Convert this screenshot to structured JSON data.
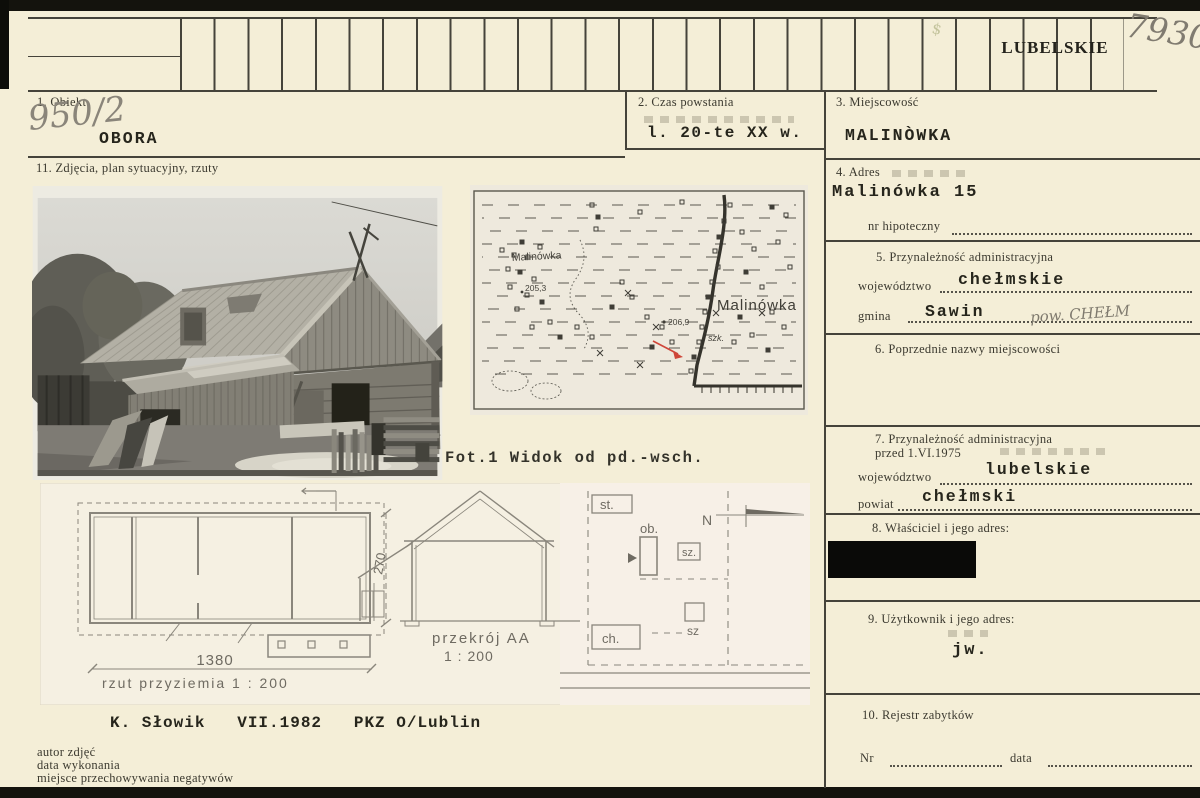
{
  "scan": {
    "region_stamp": "LUBELSKIE",
    "archive_number": "7930",
    "stamp_mark": "$"
  },
  "fields": {
    "obiekt": {
      "label": "1. Obiekt",
      "handwritten_no": "950/2",
      "value": "OBORA"
    },
    "czas": {
      "label": "2. Czas powstania",
      "value": "l. 20-te XX w."
    },
    "miejscowosc": {
      "label": "3. Miejscowość",
      "value": "MALINÒWKA"
    },
    "adres": {
      "label": "4. Adres",
      "value": "Malinówka 15",
      "hipoteczny_label": "nr hipoteczny"
    },
    "przynaleznosc": {
      "label": "5. Przynależność administracyjna",
      "wojewodztwo_label": "województwo",
      "wojewodztwo": "chełmskie",
      "gmina_label": "gmina",
      "gmina": "Sawin",
      "handwritten": "pow. CHEŁM"
    },
    "poprzednie": {
      "label": "6. Poprzednie nazwy miejscowości"
    },
    "przyn_przed": {
      "label": "7. Przynależność administracyjna",
      "label2": "przed 1.VI.1975",
      "wojewodztwo_label": "województwo",
      "wojewodztwo": "lubelskie",
      "powiat_label": "powiat",
      "powiat": "chełmski"
    },
    "wlasciciel": {
      "label": "8. Właściciel i jego adres:"
    },
    "uzytkownik": {
      "label": "9. Użytkownik i jego adres:",
      "value": "jw."
    },
    "rejestr": {
      "label": "10. Rejestr zabytków",
      "nr_label": "Nr",
      "data_label": "data"
    },
    "zdjecia": {
      "label": "11. Zdjęcia, plan sytuacyjny, rzuty"
    }
  },
  "photo": {
    "caption": "Fot.1 Widok od pd.-wsch."
  },
  "map": {
    "label_small": "Malinówka",
    "label_large": "Malinówka",
    "elev1": "205,3",
    "elev2": "206,9",
    "school": "szk."
  },
  "drawings": {
    "dim_len": "1380",
    "dim_h": "270",
    "plan_caption": "rzut przyziemia  1 : 200",
    "section_caption": "przekrój AA",
    "section_scale": "1 : 200",
    "site": {
      "st": "st.",
      "ob": "ob.",
      "sz_a": "sz.",
      "sz_b": "sz",
      "ch": "ch.",
      "north": "N"
    }
  },
  "footer": {
    "credit": "K. Słowik   VII.1982   PKZ O/Lublin",
    "notes": [
      "autor zdjęć",
      "data wykonania",
      "miejsce przechowywania negatywów"
    ]
  },
  "colors": {
    "card": "#f4eed7",
    "ink": "#26251c",
    "rule": "#45433a",
    "pencil": "#8a857a",
    "red_arrow": "#cf4639",
    "map_paper": "#eee9dd",
    "drawing_paper": "#f5f0e2",
    "redaction": "#0a0a08"
  }
}
